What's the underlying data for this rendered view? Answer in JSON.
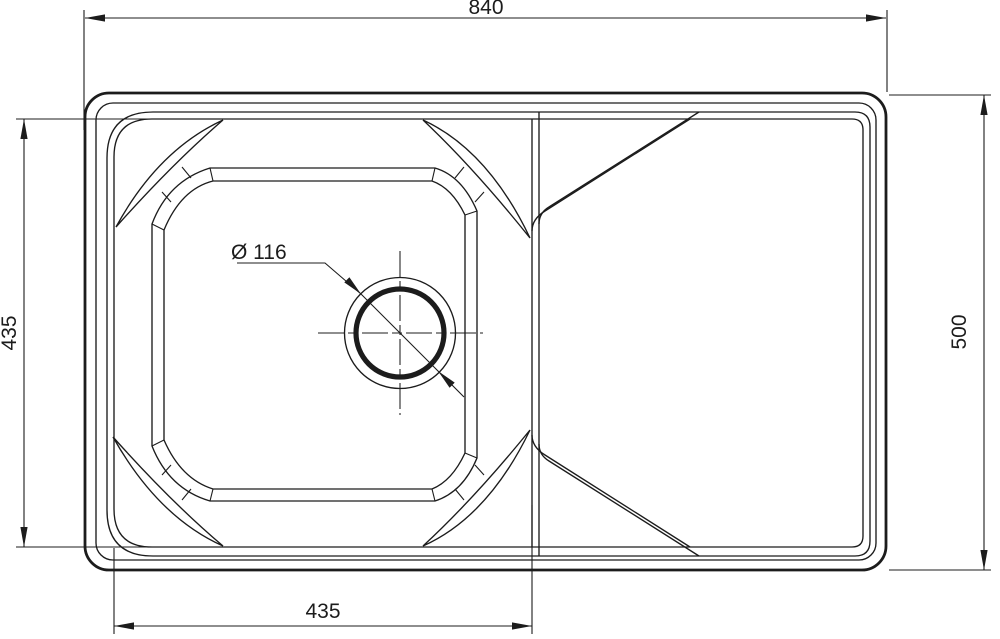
{
  "drawing": {
    "type": "technical-dimension-drawing",
    "subject": "kitchen sink top view with bowl and drainboard",
    "colors": {
      "line": "#1c1c1c",
      "background": "#ffffff"
    },
    "dimensions": {
      "overall_width": "840",
      "overall_depth": "500",
      "bowl_width": "435",
      "bowl_depth": "435",
      "drain_diameter": "Ø 116"
    }
  }
}
